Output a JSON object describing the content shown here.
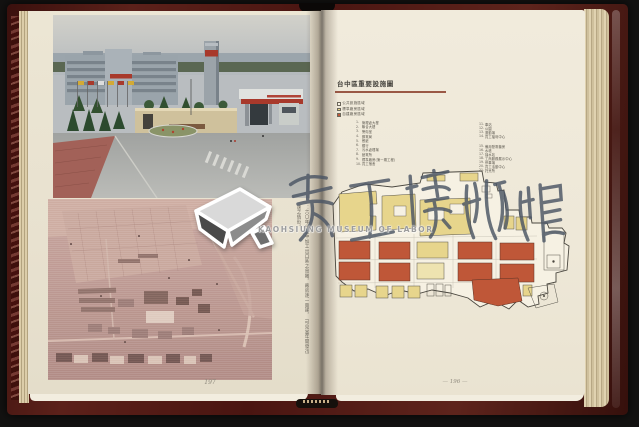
{
  "book": {
    "left_page": {
      "page_number": "197",
      "caption": {
        "line1": "：六〇年代台中加工出口區之鳥瞰，廠房逐一興建，",
        "line2": "可見當年開發迅速之情形。"
      }
    },
    "right_page": {
      "page_number": "— 196 —",
      "map_title": "台中區重要設施圖",
      "legend": [
        {
          "label": "公共設施區域",
          "color": "#f6f1e3"
        },
        {
          "label": "標準廠房區域",
          "color": "#e7d58c"
        },
        {
          "label": "自建廠房區域",
          "color": "#bf5738"
        }
      ],
      "facilities_col1": [
        {
          "num": "1.",
          "label": "管理處大樓"
        },
        {
          "num": "2.",
          "label": "聯合大樓"
        },
        {
          "num": "3.",
          "label": "警衛室"
        },
        {
          "num": "4.",
          "label": "郵電局"
        },
        {
          "num": "5.",
          "label": "餐廳"
        },
        {
          "num": "6.",
          "label": "銀行"
        },
        {
          "num": "7.",
          "label": "污水處理場"
        },
        {
          "num": "8.",
          "label": "變電所"
        },
        {
          "num": "9.",
          "label": "標準廠房(第一期工程)"
        },
        {
          "num": "10.",
          "label": "員工宿舍"
        }
      ],
      "facilities_col2a": [
        {
          "num": "11.",
          "label": "車站"
        },
        {
          "num": "12.",
          "label": "公園"
        },
        {
          "num": "13.",
          "label": "運動場"
        },
        {
          "num": "14.",
          "label": "員工福利中心"
        }
      ],
      "facilities_col2b": [
        {
          "num": "15.",
          "label": "備用發電機房"
        },
        {
          "num": "16.",
          "label": "水塔"
        },
        {
          "num": "17.",
          "label": "抽水站"
        },
        {
          "num": "18.",
          "label": "工商服務展示中心"
        },
        {
          "num": "19.",
          "label": "停車場"
        },
        {
          "num": "20.",
          "label": "員工活動中心"
        },
        {
          "num": "21.",
          "label": "托兒所"
        }
      ]
    }
  },
  "watermark": {
    "calligraphy": "勞工博物館",
    "latin": "KAOHSIUNG MUSEUM OF LABOR"
  },
  "colors": {
    "cover": "#4d1a15",
    "page_left": "#e9e3d1",
    "page_right": "#efe9da",
    "map_yellow": "#e7d58c",
    "map_red": "#bf5738",
    "title_rule": "#9a5845",
    "watermark_ink": "#4b5564"
  }
}
